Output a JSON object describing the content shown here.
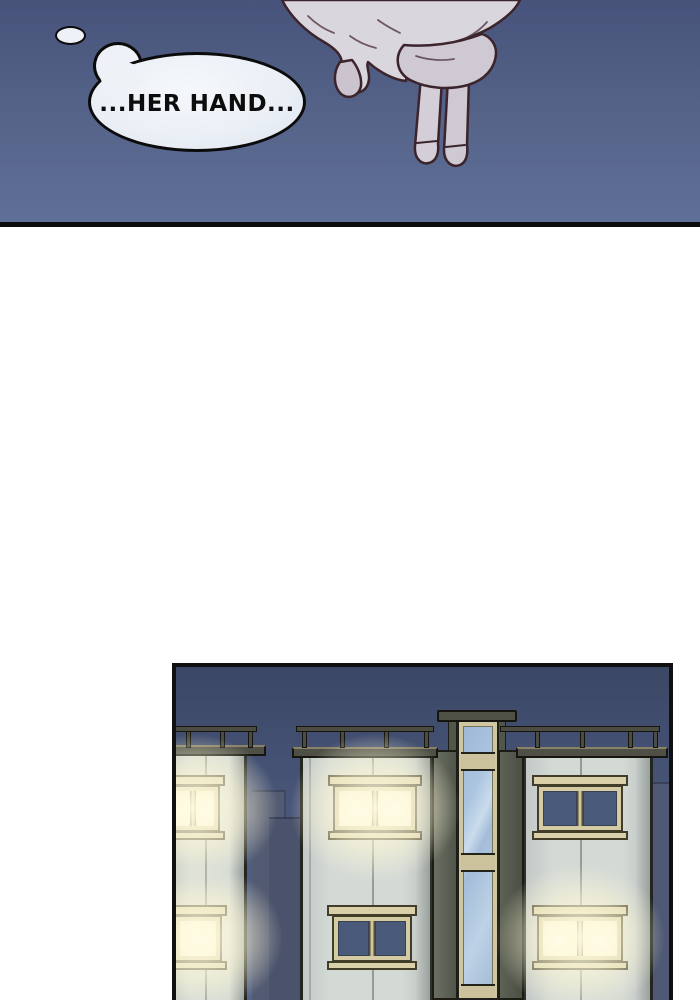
{
  "panel1": {
    "bubble_text": "...HER HAND...",
    "colors": {
      "sky_top": "#47537a",
      "sky_bottom": "#5f6f97",
      "bubble_fill": "#eef2f8",
      "bubble_outline": "#0b0b0b",
      "hand_skin": "#cfc9d4",
      "sleeve": "#dad6de",
      "line_art": "#3c242c"
    }
  },
  "panel2": {
    "colors": {
      "sky_top": "#3b4765",
      "sky_bottom": "#55648a",
      "facade": "#d3d9d5",
      "roof": "#4e5046",
      "railing": "#4c4c42",
      "window_frame": "#d4cba4",
      "dark_glass": "#4a5a7a",
      "lit_glass": "#fefdf2",
      "glow": "#fff9d8",
      "stair_glass": "#a3bcd8",
      "stair_wall": "#51564a",
      "floor_band": "#ccc29c",
      "silhouette": "#4a526c",
      "panel_border": "#101010"
    },
    "buildings": [
      {
        "id": "left",
        "windows": [
          {
            "lit": true
          },
          {
            "lit": true
          }
        ]
      },
      {
        "id": "middle",
        "windows": [
          {
            "lit": true
          },
          {
            "lit": false
          }
        ]
      },
      {
        "id": "right",
        "windows": [
          {
            "lit": false
          },
          {
            "lit": true
          }
        ]
      }
    ]
  }
}
